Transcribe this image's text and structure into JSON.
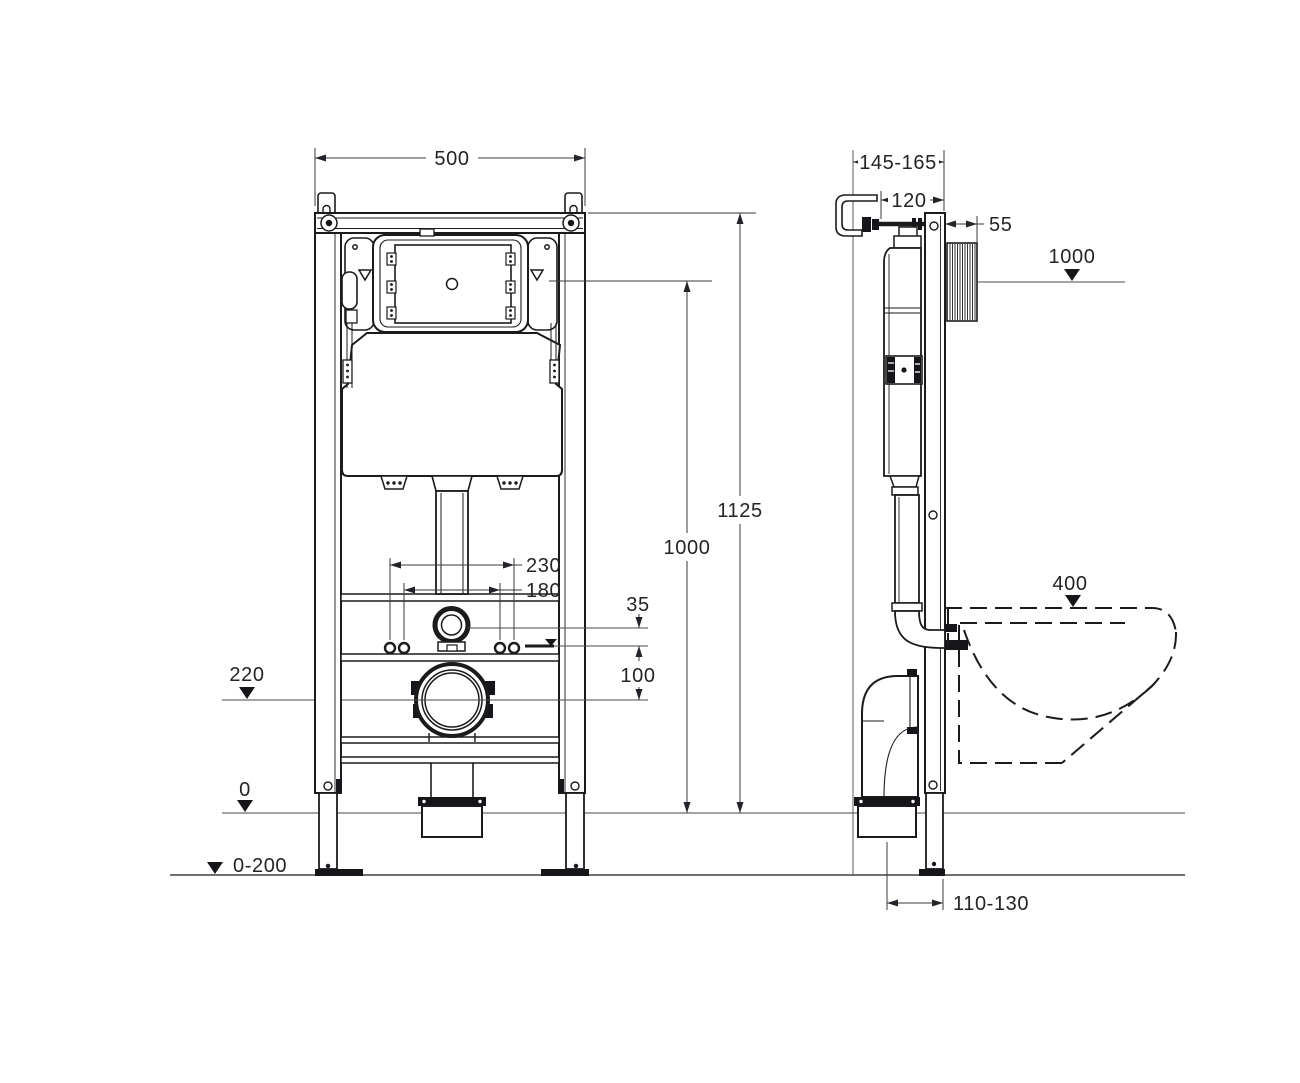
{
  "drawing": {
    "type": "installation frame technical drawing",
    "colors": {
      "line": "#1b1b1d",
      "dimension": "#3a3a3e",
      "text": "#242428",
      "background": "#ffffff"
    },
    "front_view": {
      "width": "500",
      "frame_height": "1125",
      "panel_height": "1000",
      "bolt_spacing_outer": "230",
      "bolt_spacing_inner": "180",
      "inlet_to_waterline": "35",
      "waterline_to_drain": "100",
      "drain_center_height": "220",
      "zero_level": "0",
      "floor_adjust_range": "0-200"
    },
    "side_view": {
      "install_depth_range": "145-165",
      "bracket_offset": "120",
      "shaft_protrusion": "55",
      "panel_height": "1000",
      "bowl_rim_height": "400",
      "bowl_rim_tol_plus": "+20",
      "bowl_rim_tol_minus": "-10",
      "outlet_offset_range": "110-130"
    }
  }
}
